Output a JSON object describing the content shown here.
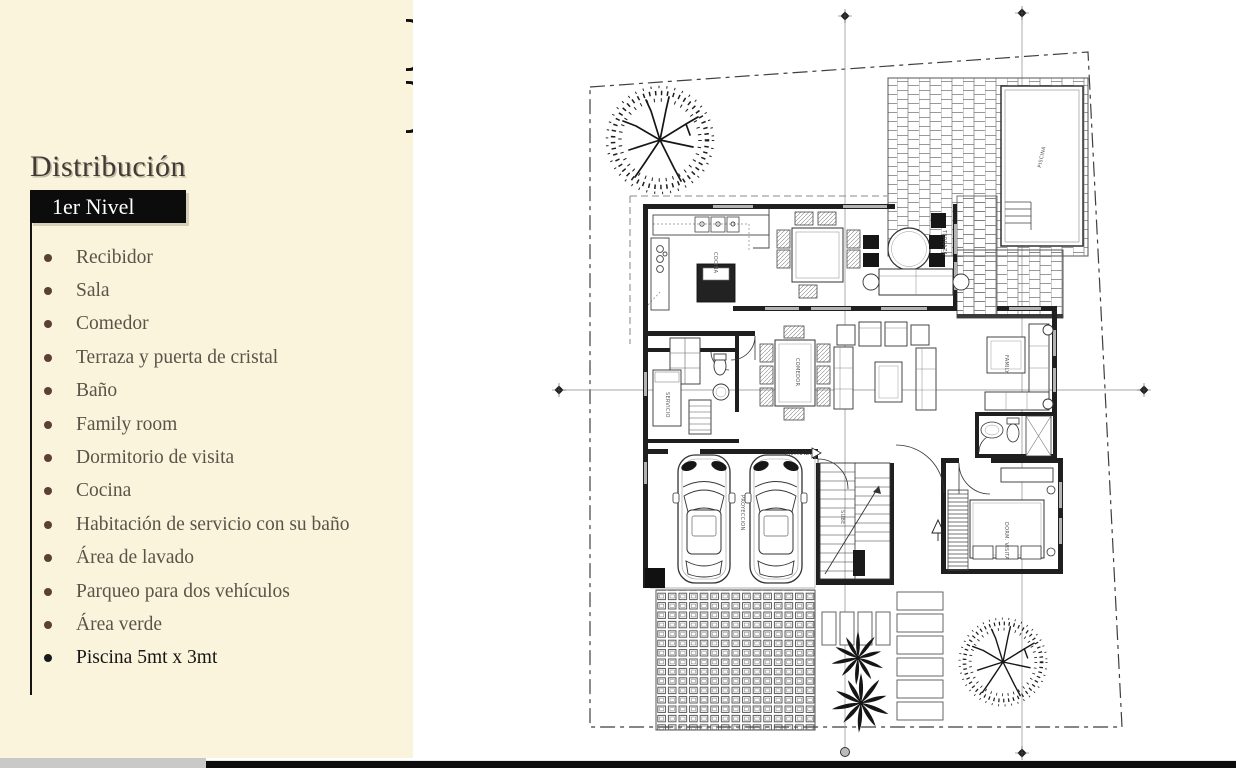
{
  "panel": {
    "title": "Distribución",
    "level_badge": "1er Nivel",
    "items": [
      "Recibidor",
      "Sala",
      "Comedor",
      "Terraza y puerta de cristal",
      "Baño",
      "Family room",
      "Dormitorio de visita",
      "Cocina",
      "Habitación de servicio con su baño",
      "Área de lavado",
      "Parqueo para dos vehículos",
      "Área verde",
      "Piscina  5mt x 3mt"
    ],
    "colors": {
      "background": "#fbf4dc",
      "title_text": "#403b35",
      "item_text": "#5d5248",
      "bullet": "#5a4035",
      "badge_bg": "#0c0c0c",
      "badge_text": "#ffffff",
      "last_item_text": "#151515"
    }
  },
  "floorplan": {
    "labels": {
      "entrada": "ENTRADA",
      "piscina": "PISCINA",
      "cocina": "COCINA",
      "comedor": "COMEDOR",
      "terraza": "TERRAZA",
      "family": "FAMILY",
      "dormitorio": "DORM. VISITA",
      "servicio": "SERVICIO",
      "sube": "SUBE",
      "proyeccion": "PROYECCION"
    },
    "colors": {
      "ink": "#1f1f1f",
      "line_gray": "#888888",
      "bar_black": "#0d0d0d",
      "bar_gray": "#c9c9c9"
    }
  },
  "decor": {
    "glyph_top": "}",
    "glyph_bottom": "}"
  }
}
